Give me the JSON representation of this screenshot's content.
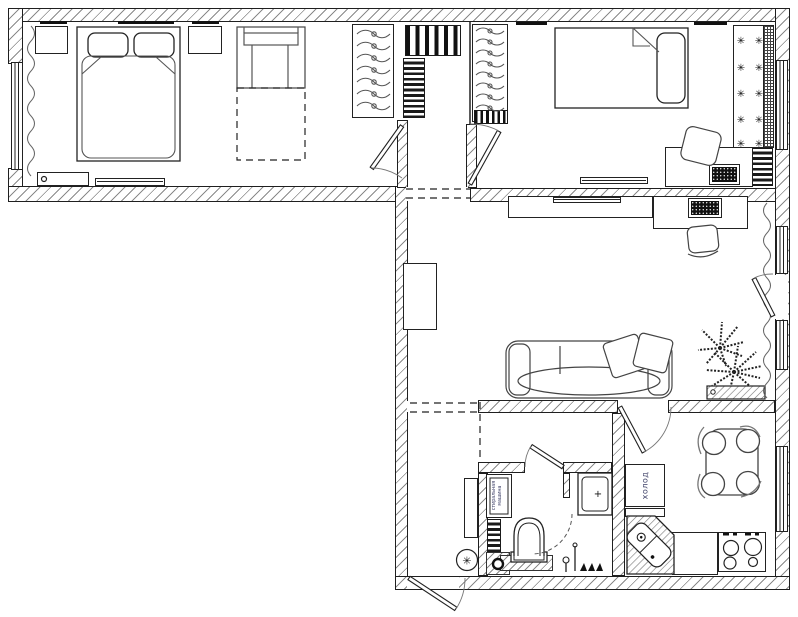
{
  "plan": {
    "type": "apartment-floor-plan",
    "labels": {
      "fridge": "холод",
      "washing_machine_line1": "стиральная",
      "washing_machine_line2": "машина"
    },
    "glyphs": {
      "decor_star": "✳",
      "fan_symbol": "✳",
      "shower_marker": "+"
    },
    "colors": {
      "line": "#1f1f1f",
      "wall_hatch": "#8a8a8a",
      "label_text": "#3c3f66",
      "background": "#ffffff"
    },
    "decor_star_grid": {
      "rows": 5,
      "columns": 2
    }
  }
}
